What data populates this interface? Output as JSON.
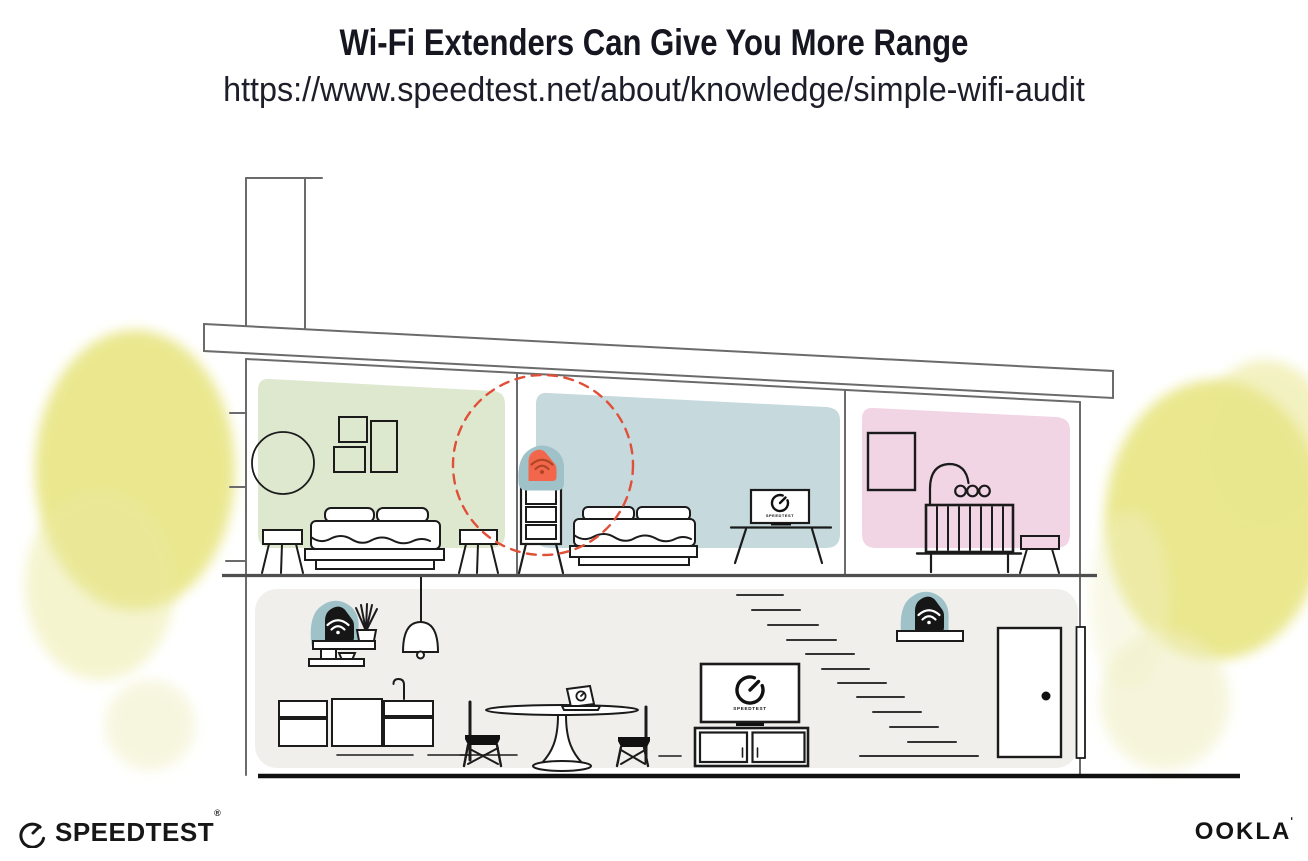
{
  "header": {
    "title": "Wi-Fi Extenders Can Give You More Range",
    "url": "https://www.speedtest.net/about/knowledge/simple-wifi-audit"
  },
  "illustration": {
    "tv_label": "SPEEDTEST",
    "icons": {
      "extender_upstairs": "wifi-extender-icon",
      "router_downstairs_left": "wifi-router-icon",
      "extender_downstairs_right": "wifi-extender-icon",
      "tv_logo": "speedtest-gauge-icon",
      "laptop_logo": "speedtest-gauge-icon"
    },
    "colors": {
      "accent_orange": "#f2674c",
      "wifi_glyph_on_orange": "#b04526",
      "device_teal": "#9fc2c9",
      "signal_circle_red": "#e04f38",
      "room_green": "#dde8cf",
      "room_blue": "#c6d9dd",
      "room_pink": "#f2d5e5",
      "floor_gray": "#f0efec",
      "foliage_yellow": "#e5e273",
      "structure_line_gray": "#6b6b6b",
      "ink": "#1b1b1b"
    }
  },
  "footer": {
    "speedtest_label": "SPEEDTEST",
    "speedtest_mark": "®",
    "ookla_label": "OOKLA",
    "ookla_mark": "ʹ"
  }
}
